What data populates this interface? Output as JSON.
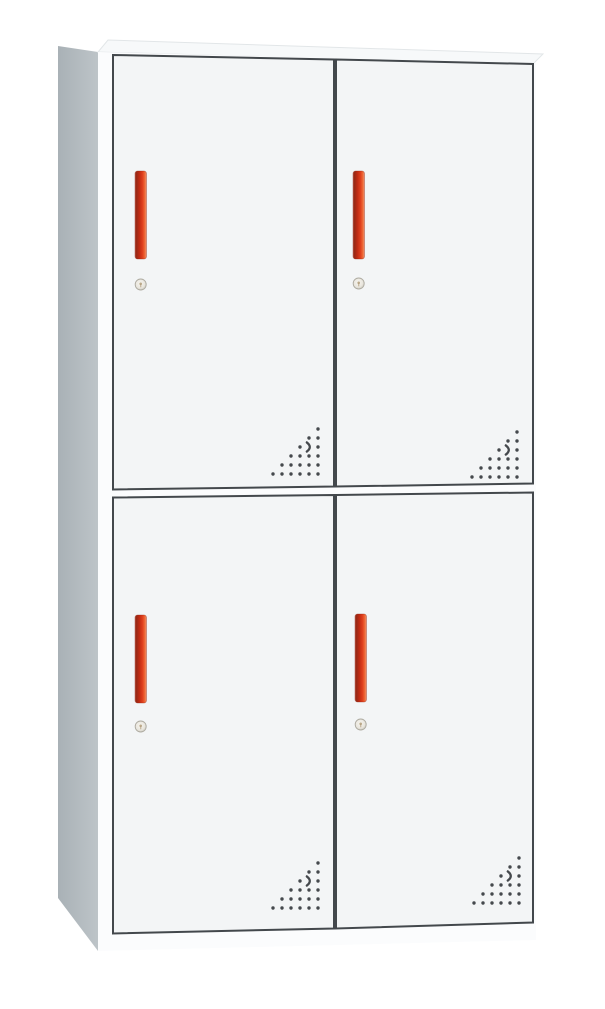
{
  "photo": {
    "subject": "two-tier four-door steel locker cabinet",
    "style": "front three-quarter product shot on plain white background"
  },
  "colors": {
    "background": "#ffffff",
    "side_dark": "#a9b1b6",
    "side_light": "#bdc4c8",
    "top_face": "#f7f9fa",
    "top_edge": "#e2e6e8",
    "front_face": "#fbfcfd",
    "door_face": "#f3f5f6",
    "door_outline": "#43484c",
    "handle": {
      "s0": "#c46553",
      "s1": "#942815",
      "s2": "#c02a12",
      "s3": "#e0401d",
      "s4": "#ee6a38",
      "s5": "#f09a78",
      "outline": "#8e2414"
    },
    "lock": {
      "face_light": "#f6f4ee",
      "face_mid": "#e9e6de",
      "face_dark": "#bdbab0",
      "rim": "#adaaa0",
      "slot": "#a8906a"
    },
    "vent_dot": "#45494d"
  },
  "cabinet": {
    "tiers": 2,
    "doors_per_tier": 2,
    "door_count": 4,
    "doors": [
      {
        "position": "top-left",
        "handle": "vertical-red-bar",
        "lock": "cam-lock-keyhole",
        "vent": "corner-dot-perforation"
      },
      {
        "position": "top-right",
        "handle": "vertical-red-bar",
        "lock": "cam-lock-keyhole",
        "vent": "corner-dot-perforation"
      },
      {
        "position": "bottom-left",
        "handle": "vertical-red-bar",
        "lock": "cam-lock-keyhole",
        "vent": "corner-dot-perforation"
      },
      {
        "position": "bottom-right",
        "handle": "vertical-red-bar",
        "lock": "cam-lock-keyhole",
        "vent": "corner-dot-perforation"
      }
    ],
    "vent_pattern": {
      "rows": 6,
      "columns": 6,
      "shape": "right-triangle-dot-grid",
      "accent": "crescent-slot"
    }
  }
}
